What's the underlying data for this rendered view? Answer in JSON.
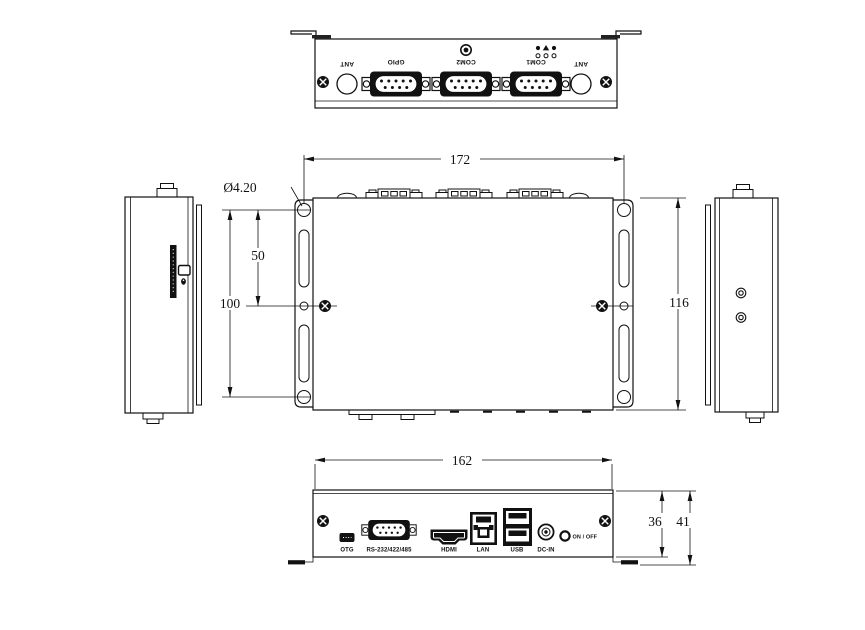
{
  "views": {
    "rear": {
      "ant_left": "ANT",
      "gpio": "GPIO",
      "com2": "COM2",
      "com1": "COM1",
      "ant_right": "ANT"
    },
    "front": {
      "otg": "OTG",
      "serial": "RS-232/422/485",
      "hdmi": "HDMI",
      "lan": "LAN",
      "usb": "USB",
      "dc_in": "DC-IN",
      "power": "ON / OFF"
    }
  },
  "dimensions": {
    "mounting_width": "172",
    "hole_diameter": "Ø4.20",
    "hole_pitch_half": "50",
    "hole_pitch_full": "100",
    "body_depth": "116",
    "front_width": "162",
    "panel_height": "36",
    "overall_height": "41"
  }
}
